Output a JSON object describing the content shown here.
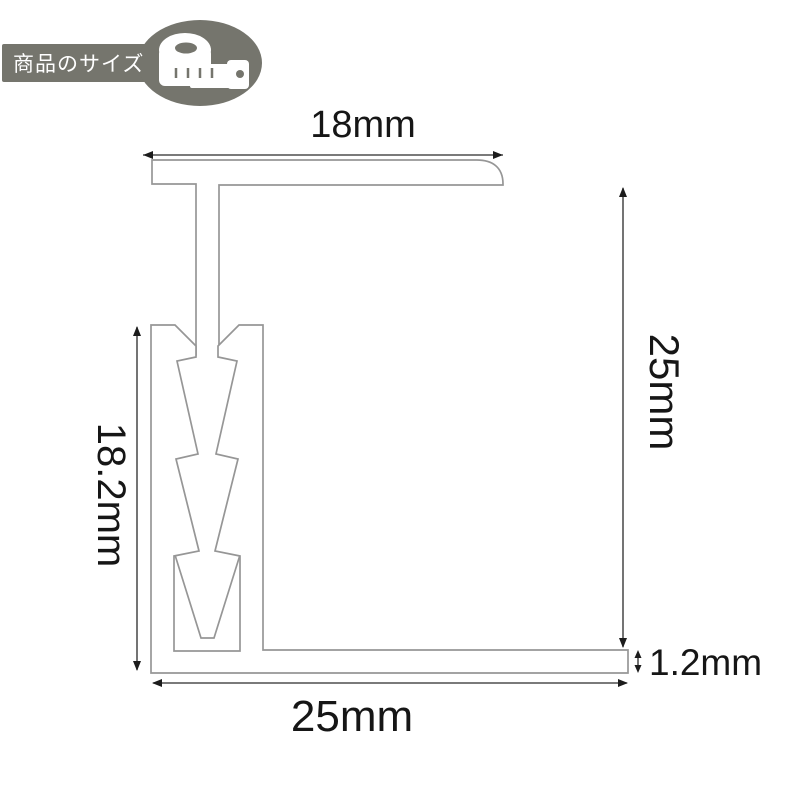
{
  "badge": {
    "label": "商品のサイズ",
    "icon": "measuring-tape",
    "bg_color": "#75756d",
    "text_color": "#ffffff"
  },
  "diagram": {
    "type": "technical-dimension-drawing",
    "subject": "metal edge trim profile cross-section",
    "outline_color": "#969696",
    "dimension_color": "#1c1c1c",
    "dimensions": {
      "top_width": "18mm",
      "right_height": "25mm",
      "left_height": "18.2mm",
      "bottom_width": "25mm",
      "base_thickness": "1.2mm"
    }
  }
}
